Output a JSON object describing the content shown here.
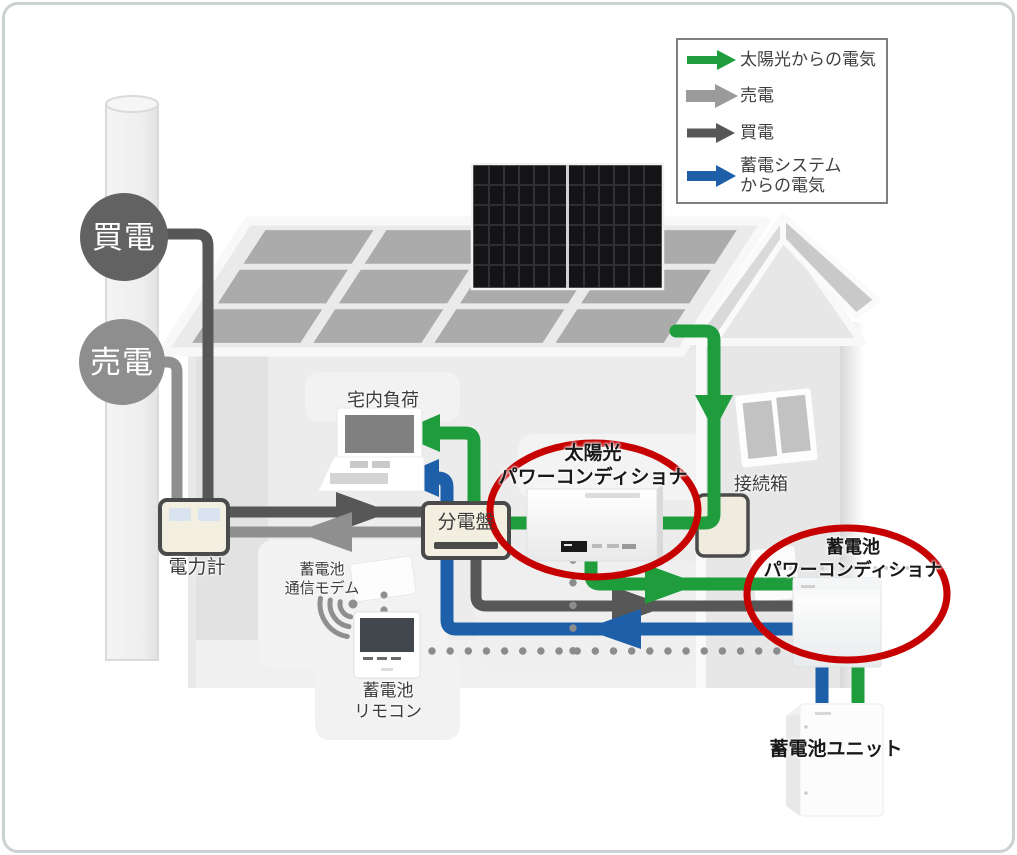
{
  "legend": {
    "items": [
      {
        "label": "太陽光からの電気",
        "color": "#1f9d3c"
      },
      {
        "label": "売電",
        "color": "#9a9a9a"
      },
      {
        "label": "買電",
        "color": "#575757"
      },
      {
        "label": "蓄電システム\nからの電気",
        "color": "#1d5fa9"
      }
    ]
  },
  "grid": {
    "buy": "買電",
    "sell": "売電"
  },
  "labels": {
    "power_meter": "電力計",
    "home_load": "宅内負荷",
    "distribution_board": "分電盤",
    "solar_pcs": "太陽光\nパワーコンディショナ",
    "junction_box": "接続箱",
    "battery_pcs": "蓄電池\nパワーコンディショナ",
    "battery_modem": "蓄電池\n通信モデム",
    "battery_remote": "蓄電池\nリモコン",
    "battery_unit": "蓄電池ユニット"
  },
  "colors": {
    "solar_green": "#1f9d3c",
    "sell_gray": "#8f8f8f",
    "buy_gray": "#575757",
    "battery_blue": "#1d5fa9",
    "highlight_red": "#c60000",
    "comm_dot": "#8c8c8c",
    "buy_circle": "#626262",
    "sell_circle": "#8e8e8e"
  }
}
